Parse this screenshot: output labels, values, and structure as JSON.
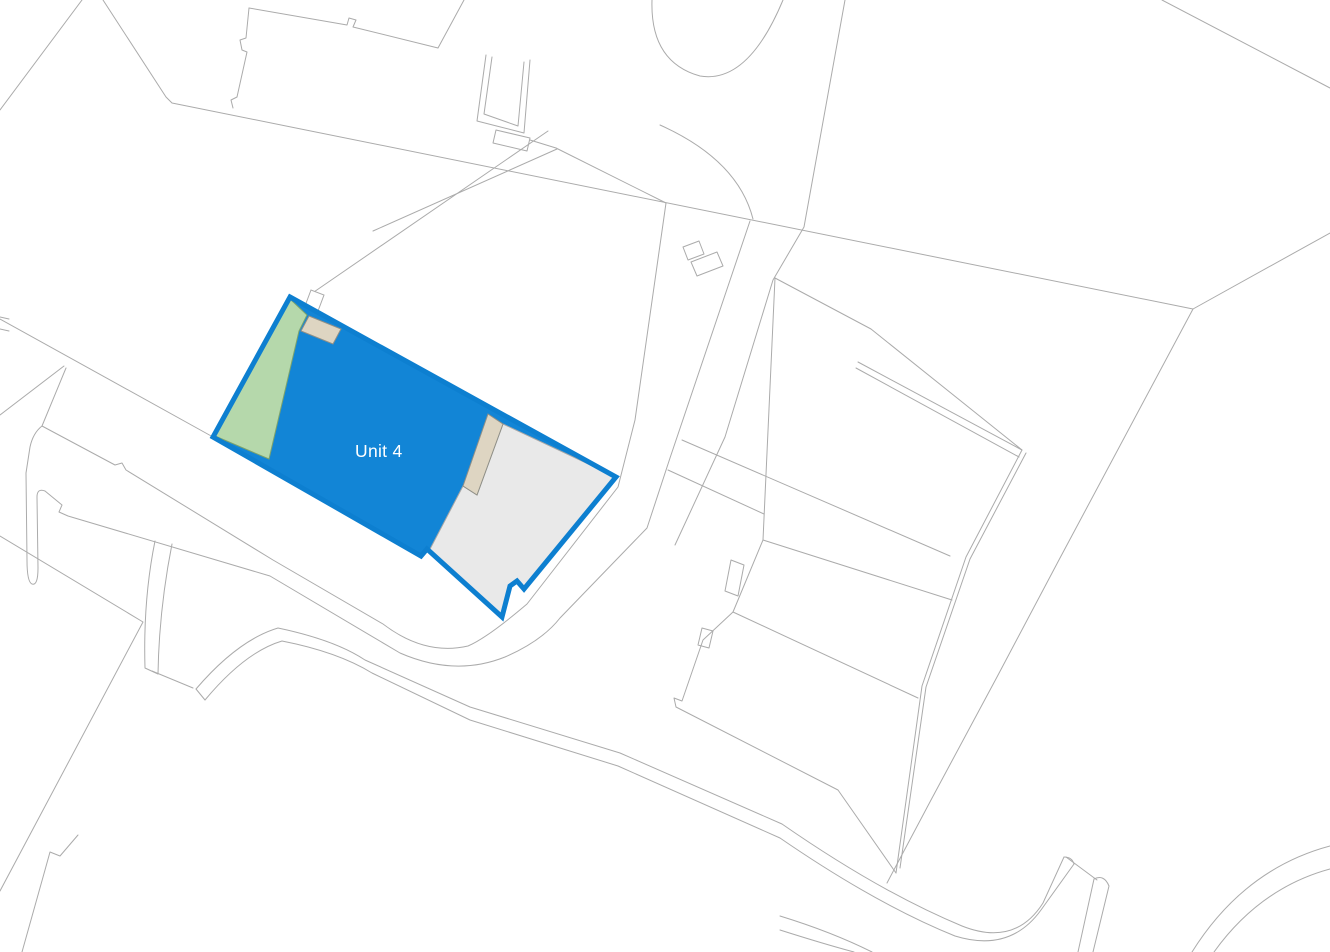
{
  "map": {
    "title": "Site plan",
    "parcel": {
      "label": "Unit 4",
      "zones": [
        "landscaped-area",
        "main-building",
        "yard-area",
        "outbuilding-strips"
      ]
    },
    "colors": {
      "background": "#ffffff",
      "base_line": "#ababab",
      "parcel_border": "#0d7fd0",
      "parcel_fill": "#1285d6",
      "landscape_fill": "#b5d8ab",
      "landscape_border": "#7ca36c",
      "yard_fill": "#e9e9e9",
      "yard_border": "#a6a6a6",
      "outbuilding_fill": "#ded5c2",
      "outbuilding_border": "#8f8f87",
      "label_color": "#ffffff"
    }
  }
}
